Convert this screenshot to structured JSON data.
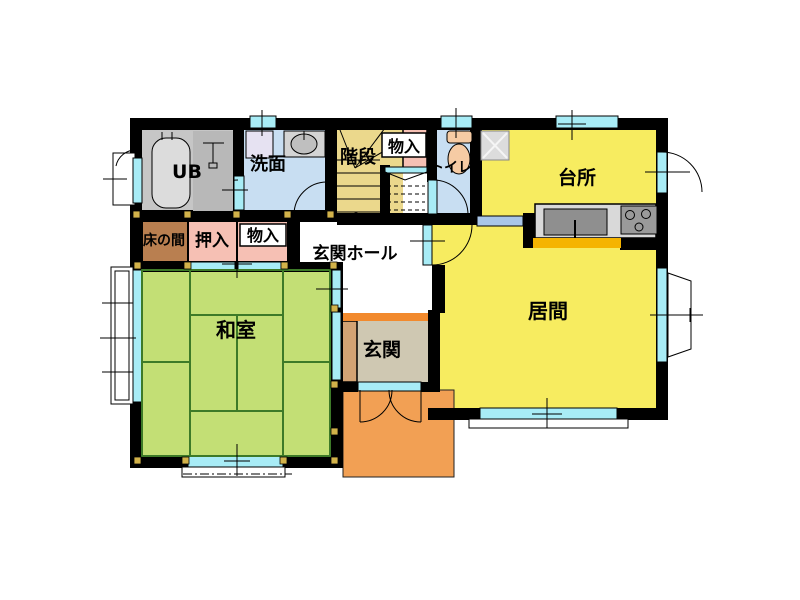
{
  "plan": {
    "rooms": {
      "ub": {
        "label": "UB",
        "color": "#C6C6C6"
      },
      "senmen": {
        "label": "洗面",
        "color": "#C8DEF2"
      },
      "kaidan": {
        "label": "階段",
        "color": "#EBD88C"
      },
      "monoire_upper": {
        "label": "物入",
        "color": "#F6C0B4"
      },
      "toilet": {
        "label": "トイレ",
        "color": "#C8DEF2"
      },
      "daidokoro": {
        "label": "台所",
        "color": "#F7EC60"
      },
      "tokonoma": {
        "label": "床の間",
        "color": "#B97F50"
      },
      "oshiire": {
        "label": "押入",
        "color": "#F6C0B4"
      },
      "monoire_lower": {
        "label": "物入",
        "color": "#F6C0B4"
      },
      "genkan_hall": {
        "label": "玄関ホール",
        "color": "#FFFFFF"
      },
      "washitsu": {
        "label": "和室",
        "color": "#C3DF75"
      },
      "genkan": {
        "label": "玄関",
        "color": "#CFC8B2"
      },
      "ima": {
        "label": "居間",
        "color": "#F7EC60"
      },
      "porch": {
        "color": "#F2A054"
      }
    },
    "colors": {
      "wall": "#000000",
      "window": "#A8ECF6",
      "slide_door": "#A9C6E8",
      "tatami_line": "#3D7A28",
      "pillar": "#D2B24A",
      "agari_kamachi": "#F28A2D",
      "counter": "#D9D9D9",
      "counter_edge": "#F5B400",
      "sink": "#8F8F8F",
      "stove": "#9A9A9A",
      "fixture_peach": "#F6CBA4",
      "genkan_step": "#D2A374",
      "washer_pad": "#E6E2F2",
      "tile_pad": "#DCDCDC"
    }
  }
}
